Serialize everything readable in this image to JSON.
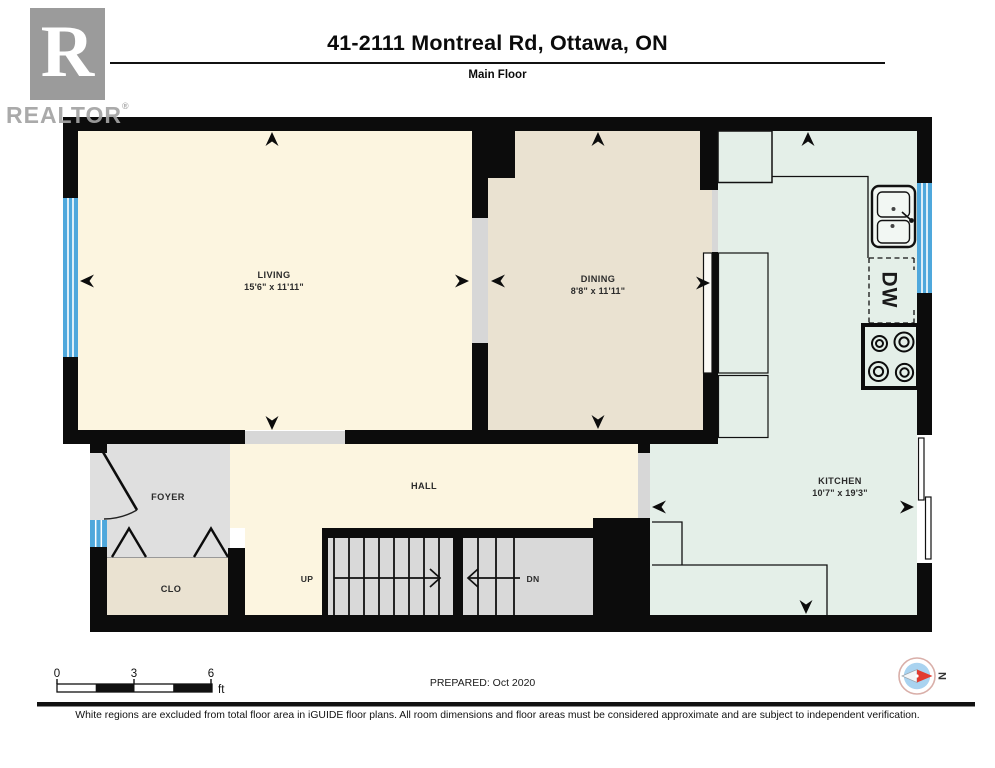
{
  "header": {
    "title": "41-2111 Montreal Rd, Ottawa, ON",
    "subtitle": "Main Floor",
    "logo_letter": "R",
    "logo_wordmark": "REALTOR",
    "logo_reg": "®"
  },
  "rooms": {
    "living": {
      "name": "LIVING",
      "dims": "15'6\" x 11'11\""
    },
    "dining": {
      "name": "DINING",
      "dims": "8'8\" x 11'11\""
    },
    "kitchen": {
      "name": "KITCHEN",
      "dims": "10'7\" x 19'3\""
    },
    "foyer": {
      "name": "FOYER"
    },
    "hall": {
      "name": "HALL"
    },
    "closet": {
      "name": "CLO"
    },
    "stairs_up": {
      "label": "UP"
    },
    "stairs_down": {
      "label": "DN"
    }
  },
  "fixtures": {
    "dishwasher_label": "DW"
  },
  "scale_bar": {
    "tick_0": "0",
    "tick_3": "3",
    "tick_6": "6",
    "unit": "ft"
  },
  "footer": {
    "prepared": "PREPARED: Oct 2020",
    "disclaimer": "White regions are excluded from total floor area in iGUIDE floor plans. All room dimensions and floor areas must be considered approximate and are subject to independent verification.",
    "compass_north": "N"
  },
  "colors": {
    "wall": "#0c0c0c",
    "living_floor": "#FCF5E0",
    "dining_floor": "#EAE2D1",
    "kitchen_floor": "#E4EFE8",
    "excluded_floor": "#DFDFDF",
    "stairs_floor": "#D9D9D9",
    "window_blue": "#4FA8DC",
    "compass_blue": "#A9D3F0",
    "compass_red": "#E23B30"
  }
}
